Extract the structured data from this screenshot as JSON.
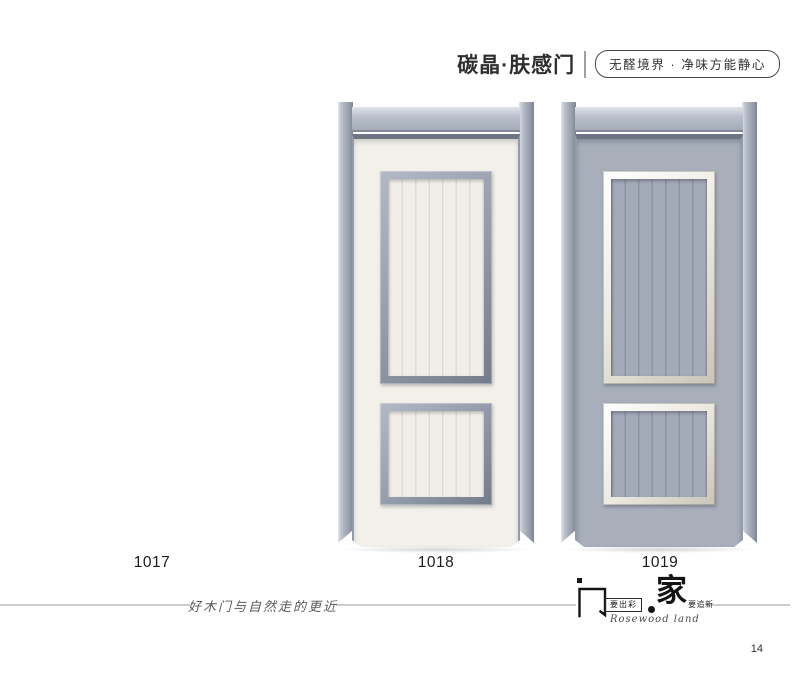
{
  "header": {
    "title": "碳晶·肤感门",
    "badge": "无醛境界 · 净味方能静心"
  },
  "products": [
    {
      "model": "1017",
      "image_shown": false
    },
    {
      "model": "1018",
      "image_shown": true,
      "body_color": "#f2f0e9",
      "frame_color": "#a9b0bc",
      "panel_trim_color": "#98a0af",
      "panel_count": 2,
      "panel_texture": "vertical-grooves"
    },
    {
      "model": "1019",
      "image_shown": true,
      "body_color": "#a8afbb",
      "frame_color": "#a9b0bc",
      "panel_trim_color": "#ece9e0",
      "panel_count": 2,
      "panel_texture": "vertical-grooves"
    }
  ],
  "footer": {
    "slogan": "好木门与自然走的更近",
    "logo": {
      "door_char": "门",
      "door_tag": "要出彩",
      "home_char": "家",
      "home_tag": "要追新",
      "script_text": "Rosewood land"
    },
    "page_number": "14"
  },
  "palette": {
    "page_background": "#ffffff",
    "frame_gray": "#a9b0bc",
    "frame_shadow": "#7d8594",
    "door_cream": "#f2f0e9",
    "door_gray": "#a8afbb",
    "rule_gray": "#cccccc",
    "text_dark": "#2e2e2e"
  }
}
